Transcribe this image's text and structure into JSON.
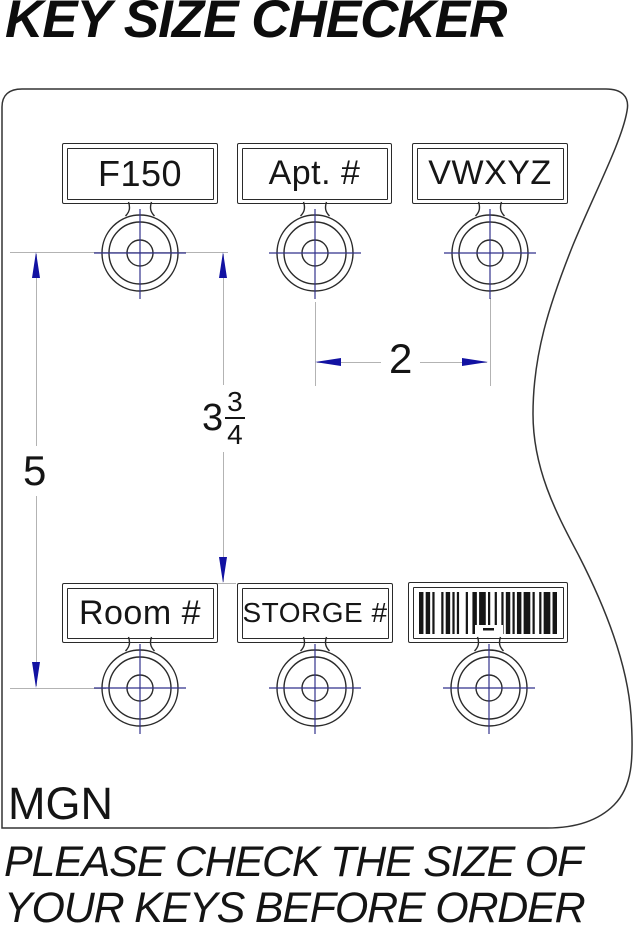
{
  "title": "KEY SIZE CHECKER",
  "drawing": {
    "maker_code": "MGN",
    "notice_line1": "PLEASE CHECK THE SIZE OF",
    "notice_line2": "YOUR KEYS BEFORE ORDER"
  },
  "keys": [
    {
      "label": "F150"
    },
    {
      "label": "Apt. #"
    },
    {
      "label": "VWXYZ"
    },
    {
      "label": "Room #"
    },
    {
      "label": "STORGE #"
    },
    {
      "label": "",
      "type": "barcode",
      "barcode_pattern": "21211311211113122131121211211121311211312"
    }
  ],
  "dimensions": {
    "horizontal_spacing": {
      "value": "2"
    },
    "vertical_inner": {
      "whole": "3",
      "numerator": "3",
      "denominator": "4"
    },
    "vertical_outer": {
      "value": "5"
    }
  },
  "colors": {
    "arrow": "#1212a2",
    "drawing_line": "#2a2a2a",
    "crosshair_line": "#32328c",
    "extension_line": "#b3b3b3",
    "text": "#111111"
  }
}
